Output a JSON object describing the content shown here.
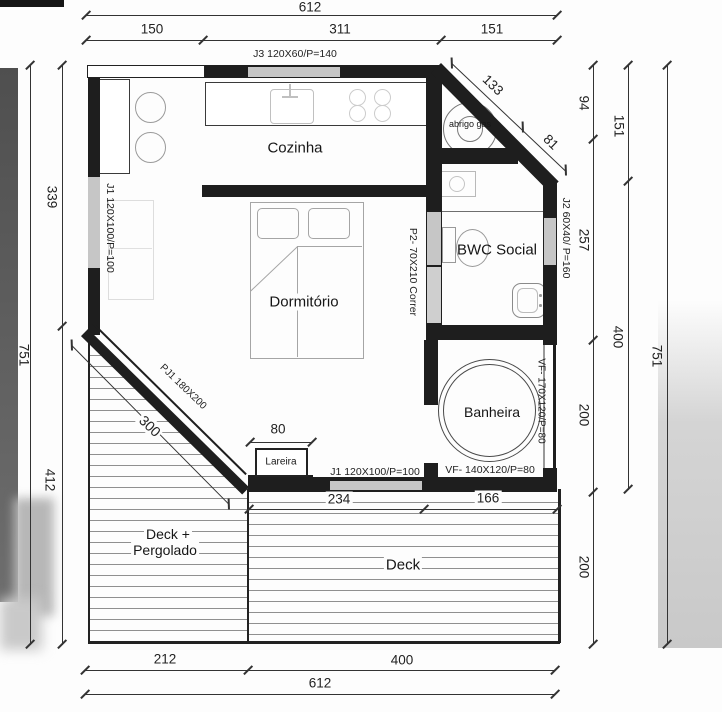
{
  "rooms": {
    "cozinha": "Cozinha",
    "dormitorio": "Dormitório",
    "bwc": "BWC Social",
    "banheira": "Banheira",
    "lareira": "Lareira",
    "deck_pergolado_1": "Deck +",
    "deck_pergolado_2": "Pergolado",
    "deck": "Deck",
    "abrigo_gas": "abrigo gas"
  },
  "openings": {
    "j3": "J3 120X60/P=140",
    "j1_left": "J1 120X100/P=100",
    "j1_bottom": "J1 120X100/P=100",
    "j2": "J2 60X40/ P=160",
    "p2": "P2- 70X210 Correr",
    "pj1": "PJ1 180X200",
    "vf170": "VF- 170X120/P=80",
    "vf140": "VF- 140X120/P=80"
  },
  "dims": {
    "top_total": "612",
    "top_150": "150",
    "top_311": "311",
    "top_151": "151",
    "diag_133": "133",
    "diag_81": "81",
    "right_94": "94",
    "right_257": "257",
    "right_200a": "200",
    "right_200b": "200",
    "right_151": "151",
    "right_400": "400",
    "right_751": "751",
    "left_339": "339",
    "left_412": "412",
    "left_751": "751",
    "diag_300": "300",
    "lareira_80": "80",
    "bot_234": "234",
    "bot_166": "166",
    "bot_212": "212",
    "bot_400": "400",
    "bot_total": "612"
  }
}
